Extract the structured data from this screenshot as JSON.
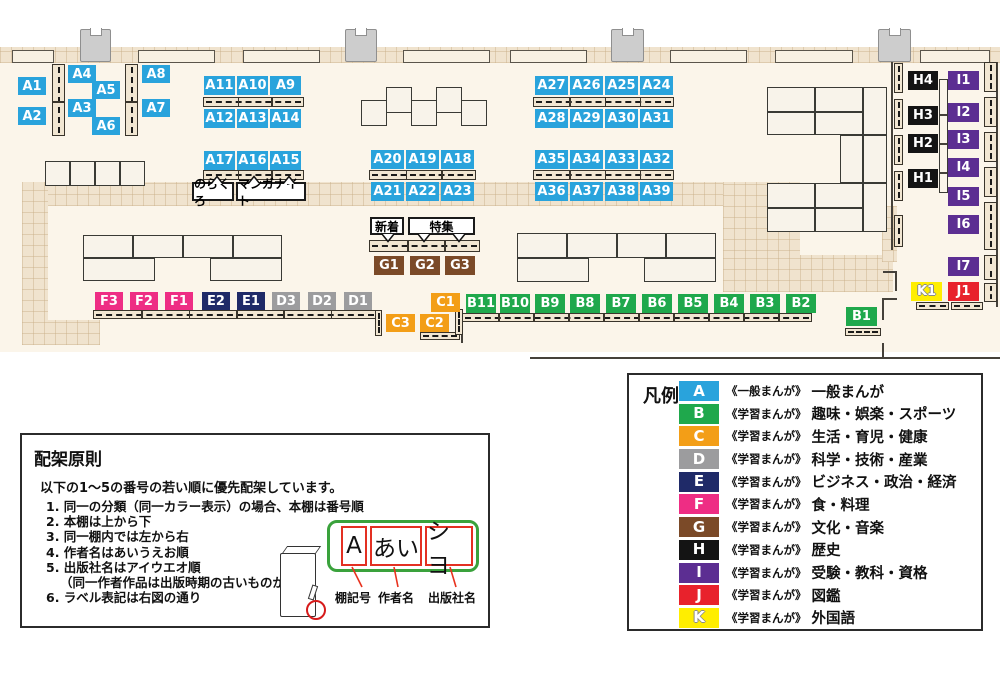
{
  "map": {
    "shelf_badges": [
      "A1",
      "A2",
      "A3",
      "A4",
      "A5",
      "A6",
      "A7",
      "A8",
      "A9",
      "A10",
      "A11",
      "A12",
      "A13",
      "A14",
      "A15",
      "A16",
      "A17",
      "A18",
      "A19",
      "A20",
      "A21",
      "A22",
      "A23",
      "A24",
      "A25",
      "A26",
      "A27",
      "A28",
      "A29",
      "A30",
      "A31",
      "A32",
      "A33",
      "A34",
      "A35",
      "A36",
      "A37",
      "A38",
      "A39",
      "B1",
      "B2",
      "B3",
      "B4",
      "B5",
      "B6",
      "B7",
      "B8",
      "B9",
      "B10",
      "B11",
      "C1",
      "C2",
      "C3",
      "D1",
      "D2",
      "D3",
      "E1",
      "E2",
      "F1",
      "F2",
      "F3",
      "G1",
      "G2",
      "G3",
      "H1",
      "H2",
      "H3",
      "H4",
      "I1",
      "I2",
      "I3",
      "I4",
      "I5",
      "I6",
      "I7",
      "J1",
      "K1"
    ],
    "area_labels": {
      "norakuro": "のらくろ",
      "manga_knight": "マンガナイト",
      "new_arrivals": "新着",
      "feature": "特集"
    }
  },
  "categories": {
    "A": "#29A3DC",
    "B": "#1FA84C",
    "C": "#F39E17",
    "D": "#9C9C9E",
    "E": "#1F2A68",
    "F": "#EE2D84",
    "G": "#7B4A28",
    "H": "#141414",
    "I": "#5C2E92",
    "J": "#E8222C",
    "K": "#FFEE00"
  },
  "legend": {
    "title": "凡例",
    "items": [
      {
        "key": "A",
        "series": "《一般まんが》",
        "label": "一般まんが"
      },
      {
        "key": "B",
        "series": "《学習まんが》",
        "label": "趣味・娯楽・スポーツ"
      },
      {
        "key": "C",
        "series": "《学習まんが》",
        "label": "生活・育児・健康"
      },
      {
        "key": "D",
        "series": "《学習まんが》",
        "label": "科学・技術・産業"
      },
      {
        "key": "E",
        "series": "《学習まんが》",
        "label": "ビジネス・政治・経済"
      },
      {
        "key": "F",
        "series": "《学習まんが》",
        "label": "食・料理"
      },
      {
        "key": "G",
        "series": "《学習まんが》",
        "label": "文化・音楽"
      },
      {
        "key": "H",
        "series": "《学習まんが》",
        "label": "歴史"
      },
      {
        "key": "I",
        "series": "《学習まんが》",
        "label": "受験・教科・資格"
      },
      {
        "key": "J",
        "series": "《学習まんが》",
        "label": "図鑑"
      },
      {
        "key": "K",
        "series": "《学習まんが》",
        "label": "外国語"
      }
    ]
  },
  "principles": {
    "title": "配架原則",
    "intro": "以下の1～5の番号の若い順に優先配架しています。",
    "rules": [
      "1. 同一の分類（同一カラー表示）の場合、本棚は番号順",
      "2. 本棚は上から下",
      "3. 同一棚内では左から右",
      "4. 作者名はあいうえお順",
      "5. 出版社名はアイウエオ順",
      "（同一作者作品は出版時期の古いものが先）",
      "6. ラベル表記は右図の通り"
    ],
    "label_example": {
      "shelf_code": "A",
      "author": "あい",
      "publisher": "シヨ",
      "annotations": [
        "棚記号",
        "作者名",
        "出版社名"
      ]
    }
  }
}
